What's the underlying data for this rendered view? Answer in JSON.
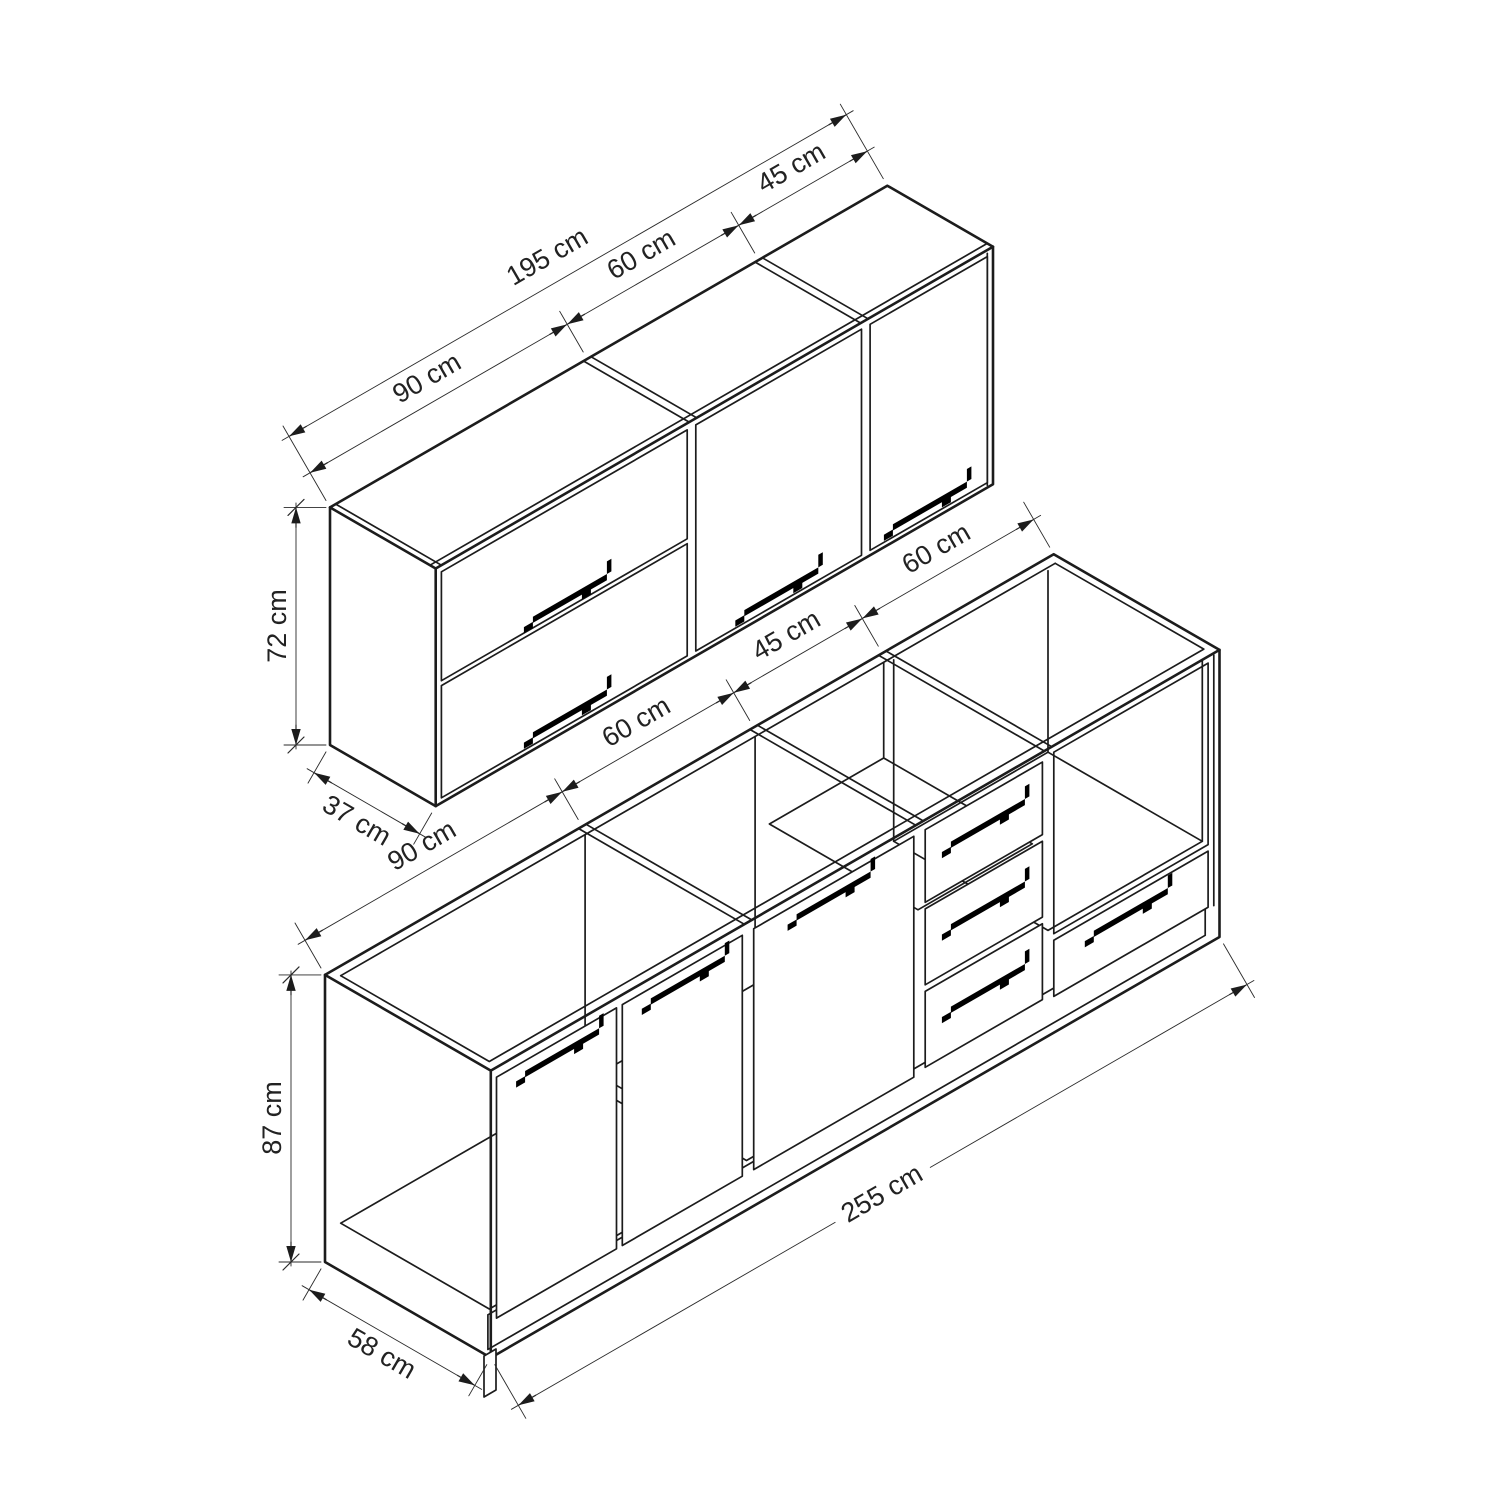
{
  "title": "Kitchen cabinet set isometric dimension drawing",
  "units": "cm",
  "wall_cabinet": {
    "total_width_label": "195 cm",
    "section_labels": [
      "90 cm",
      "60 cm",
      "45 cm"
    ],
    "height_label": "72 cm",
    "depth_label": "37 cm"
  },
  "base_cabinet": {
    "section_labels": [
      "90 cm",
      "60 cm",
      "45 cm",
      "60 cm"
    ],
    "height_label": "87 cm",
    "depth_label": "58 cm",
    "total_width_label": "255 cm"
  },
  "colors": {
    "line": "#1c1c1c",
    "dimension_line": "#2a2a2a",
    "text": "#222222",
    "handle": "#000000",
    "background": "#ffffff"
  }
}
